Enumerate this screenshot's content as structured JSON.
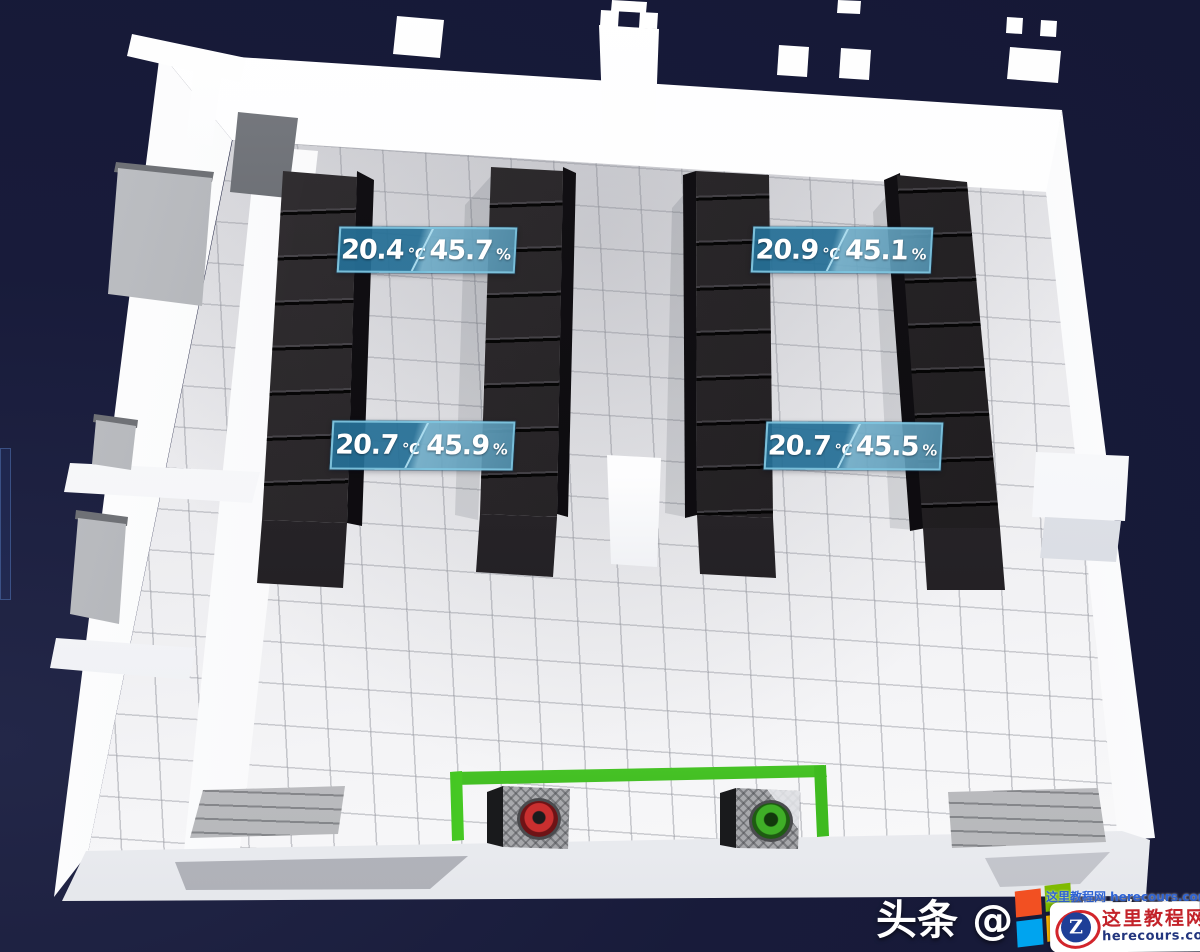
{
  "scene": {
    "description": "3D isometric server room monitoring view",
    "background_color": "#181b3a",
    "rack_row_count": 4,
    "room_features": [
      "tiled-floor",
      "white-walls",
      "left-anterooms",
      "center-pillar",
      "floor-grates",
      "green-boundary"
    ]
  },
  "sensors": [
    {
      "id": "left-group-top",
      "temperature": "20.4",
      "temperature_unit": "℃",
      "humidity": "45.7",
      "humidity_unit": "%"
    },
    {
      "id": "right-group-top",
      "temperature": "20.9",
      "temperature_unit": "℃",
      "humidity": "45.1",
      "humidity_unit": "%"
    },
    {
      "id": "left-group-bottom",
      "temperature": "20.7",
      "temperature_unit": "℃",
      "humidity": "45.9",
      "humidity_unit": "%"
    },
    {
      "id": "right-group-bottom",
      "temperature": "20.7",
      "temperature_unit": "℃",
      "humidity": "45.5",
      "humidity_unit": "%"
    }
  ],
  "devices": [
    {
      "id": "fan-unit-left",
      "indicator_color": "#c92f2f"
    },
    {
      "id": "fan-unit-right",
      "indicator_color": "#3fae27"
    }
  ],
  "colors": {
    "sensor_label_fill": "#2f7fa8",
    "sensor_label_border": "#7fc4de",
    "boundary_green": "#46d91f",
    "rack_black": "#242124",
    "windows_logo": [
      "#f25022",
      "#7fba00",
      "#00a4ef",
      "#ffb900"
    ]
  },
  "watermark": {
    "prefix": "头条 @",
    "suffix": "男的深邃"
  },
  "badge": {
    "logo_letter": "Z",
    "site_name": "这里教程网",
    "site_url": "herecours.com",
    "mini_watermark": "这里教程网 herecours.com"
  }
}
